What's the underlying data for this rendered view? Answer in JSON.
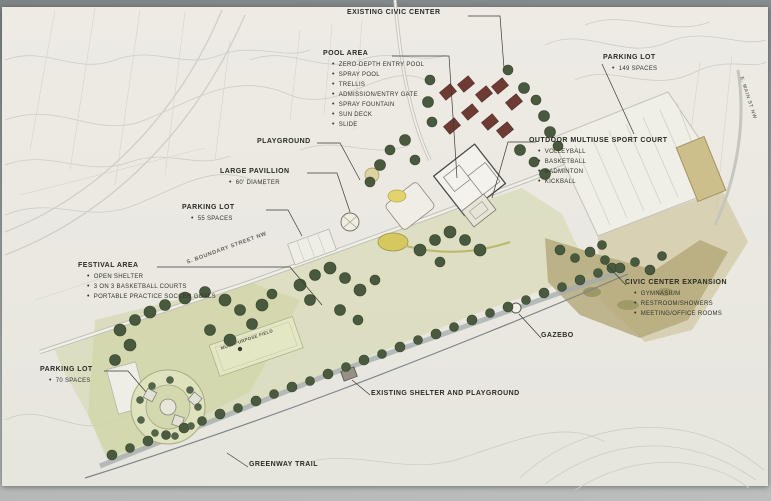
{
  "labels": {
    "existing_civic_center": {
      "title": "EXISTING CIVIC CENTER"
    },
    "pool_area": {
      "title": "POOL AREA",
      "items": [
        "ZERO-DEPTH ENTRY POOL",
        "SPRAY POOL",
        "TRELLIS",
        "ADMISSION/ENTRY GATE",
        "SPRAY FOUNTAIN",
        "SUN DECK",
        "SLIDE"
      ]
    },
    "parking_lot_ne": {
      "title": "PARKING LOT",
      "items": [
        "149 SPACES"
      ]
    },
    "outdoor_multiuse_sport_court": {
      "title": "OUTDOOR MULTIUSE SPORT COURT",
      "items": [
        "VOLLEYBALL",
        "BASKETBALL",
        "BADMINTON",
        "KICKBALL"
      ]
    },
    "playground": {
      "title": "PLAYGROUND"
    },
    "large_pavillion": {
      "title": "LARGE PAVILLION",
      "items": [
        "60' DIAMETER"
      ]
    },
    "parking_lot_mid": {
      "title": "PARKING LOT",
      "items": [
        "55 SPACES"
      ]
    },
    "festival_area": {
      "title": "FESTIVAL AREA",
      "items": [
        "OPEN SHELTER",
        "3 ON 3 BASKETBALL COURTS",
        "PORTABLE PRACTICE SOCCER GOALS"
      ]
    },
    "parking_lot_sw": {
      "title": "PARKING LOT",
      "items": [
        "70 SPACES"
      ]
    },
    "civic_center_expansion": {
      "title": "CIVIC CENTER EXPANSION",
      "items": [
        "GYMNASIUM",
        "RESTROOM/SHOWERS",
        "MEETING/OFFICE ROOMS"
      ]
    },
    "gazebo": {
      "title": "GAZEBO"
    },
    "existing_shelter_and_playground": {
      "title": "EXISTING SHELTER AND PLAYGROUND"
    },
    "greenway_trail": {
      "title": "GREENWAY TRAIL"
    }
  },
  "street_labels": {
    "boundary_street": "S. BOUNDARY STREET NW",
    "main_street": "E. MAIN ST NW"
  },
  "field_label": "MULTIPURPOSE FIELD",
  "colors": {
    "photo_background": "#94989a",
    "paper": "#eae8e1",
    "park_green": "#d4d8ad",
    "tree_green": "#4a5a3e",
    "roof_maroon": "#6e3b33",
    "pond_yellow": "#d6c75f",
    "expansion_olive": "#b3a878",
    "greenway_road": "#a3abae",
    "contour_gray": "#cccdc4",
    "label_ink": "#2b2b24"
  }
}
